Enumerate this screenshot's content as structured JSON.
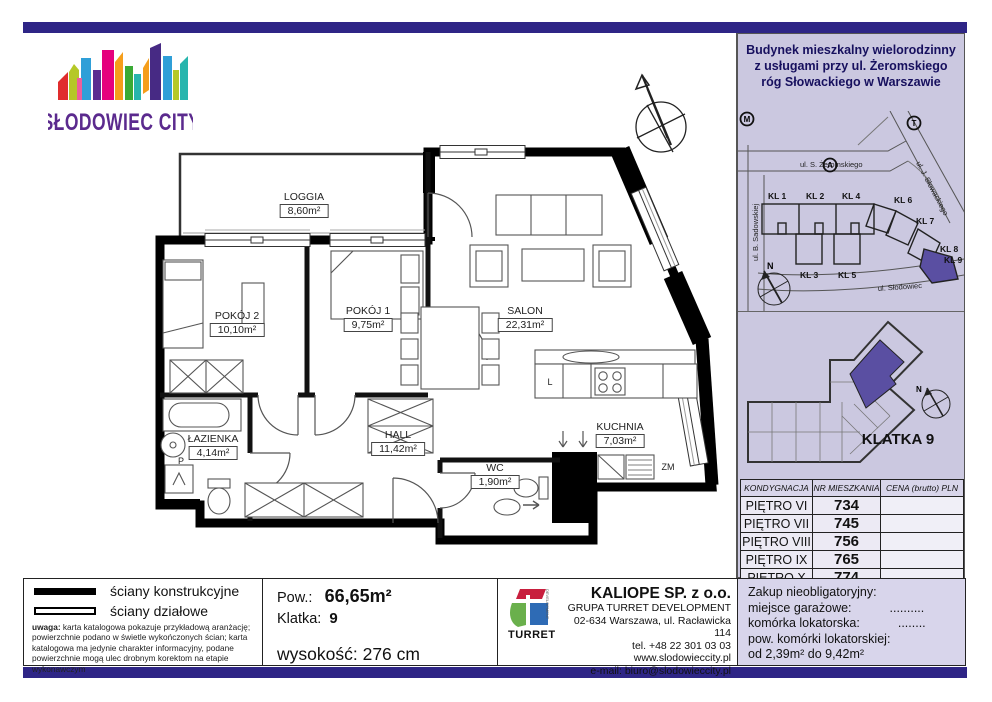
{
  "brand": {
    "name": "SŁODOWIEC CITY"
  },
  "plan": {
    "rooms": [
      {
        "name": "LOGGIA",
        "area": "8,60m²"
      },
      {
        "name": "POKÓJ 2",
        "area": "10,10m²"
      },
      {
        "name": "POKÓJ 1",
        "area": "9,75m²"
      },
      {
        "name": "SALON",
        "area": "22,31m²"
      },
      {
        "name": "KUCHNIA",
        "area": "7,03m²"
      },
      {
        "name": "HALL",
        "area": "11,42m²"
      },
      {
        "name": "WC",
        "area": "1,90m²"
      },
      {
        "name": "ŁAZIENKA",
        "area": "4,14m²"
      }
    ],
    "appliances": {
      "fridge": "L",
      "dishwasher": "ZM",
      "washer": "P"
    }
  },
  "sidebar": {
    "header": {
      "line1": "Budynek mieszkalny wielorodzinny",
      "line2": "z usługami przy ul. Żeromskiego",
      "line3": "róg Słowackiego w Warszawie"
    },
    "map": {
      "streets": {
        "zeromskiego": "ul. S. Żeromskiego",
        "sadowskiej": "ul. B. Sadowskiej",
        "slowackiego": "ul. J. Słowackiego",
        "slodowiec": "ul. Słodowiec"
      },
      "markers": {
        "metro": "M",
        "tram": "T",
        "a": "A",
        "north": "N"
      },
      "buildings": [
        "KL 1",
        "KL 2",
        "KL 4",
        "KL 3",
        "KL 5",
        "KL 6",
        "KL 7",
        "KL 8",
        "KL 9"
      ]
    },
    "floorplan": {
      "label": "KLATKA 9",
      "north": "N"
    },
    "table": {
      "headers": [
        "KONDYGNACJA",
        "NR MIESZKANIA",
        "CENA (brutto) PLN"
      ],
      "rows": [
        {
          "floor": "PIĘTRO VI",
          "number": "734",
          "price": ""
        },
        {
          "floor": "PIĘTRO VII",
          "number": "745",
          "price": ""
        },
        {
          "floor": "PIĘTRO VIII",
          "number": "756",
          "price": ""
        },
        {
          "floor": "PIĘTRO IX",
          "number": "765",
          "price": ""
        },
        {
          "floor": "PIĘTRO X",
          "number": "774",
          "price": ""
        }
      ]
    },
    "options": {
      "title": "Zakup nieobligatoryjny:",
      "item1_label": "miejsce garażowe:",
      "item1_value": "..........",
      "item2_label": "komórka lokatorska:",
      "item2_value": "........",
      "line4": "pow. komórki lokatorskiej:",
      "line5": "od 2,39m² do 9,42m²"
    }
  },
  "footer": {
    "legend": {
      "solid_label": "ściany konstrukcyjne",
      "outline_label": "ściany działowe",
      "note_bold": "uwaga:",
      "note": " karta katalogowa pokazuje przykładową aranżację; powierzchnie podano w świetle wykończonych ścian; karta katalogowa ma jedynie charakter informacyjny, podane powierzchnie mogą ulec drobnym korektom na etapie wykonawczym"
    },
    "specs": {
      "area_label": "Pow.:",
      "area_value": "66,65m²",
      "staircase_label": "Klatka:",
      "staircase_value": "9",
      "height_label": "wysokość:",
      "height_value": "276 cm"
    },
    "company": {
      "logo_text": "TURRET",
      "logo_vertical": "DEVELOPMENT",
      "name": "KALIOPE SP. z o.o.",
      "group": "GRUPA TURRET DEVELOPMENT",
      "address": "02-634 Warszawa, ul. Racławicka 114",
      "phone": "tel. +48 22 301 03 03",
      "website": "www.slodowieccity.pl",
      "email": "e-mail: biuro@slodowieccity.pl"
    }
  },
  "colors": {
    "accent_bar": "#2e2586",
    "sidebar_bg": "#cbc8e0",
    "unit_highlight": "#5a4fa2",
    "logo_text": "#5b2a8e"
  }
}
